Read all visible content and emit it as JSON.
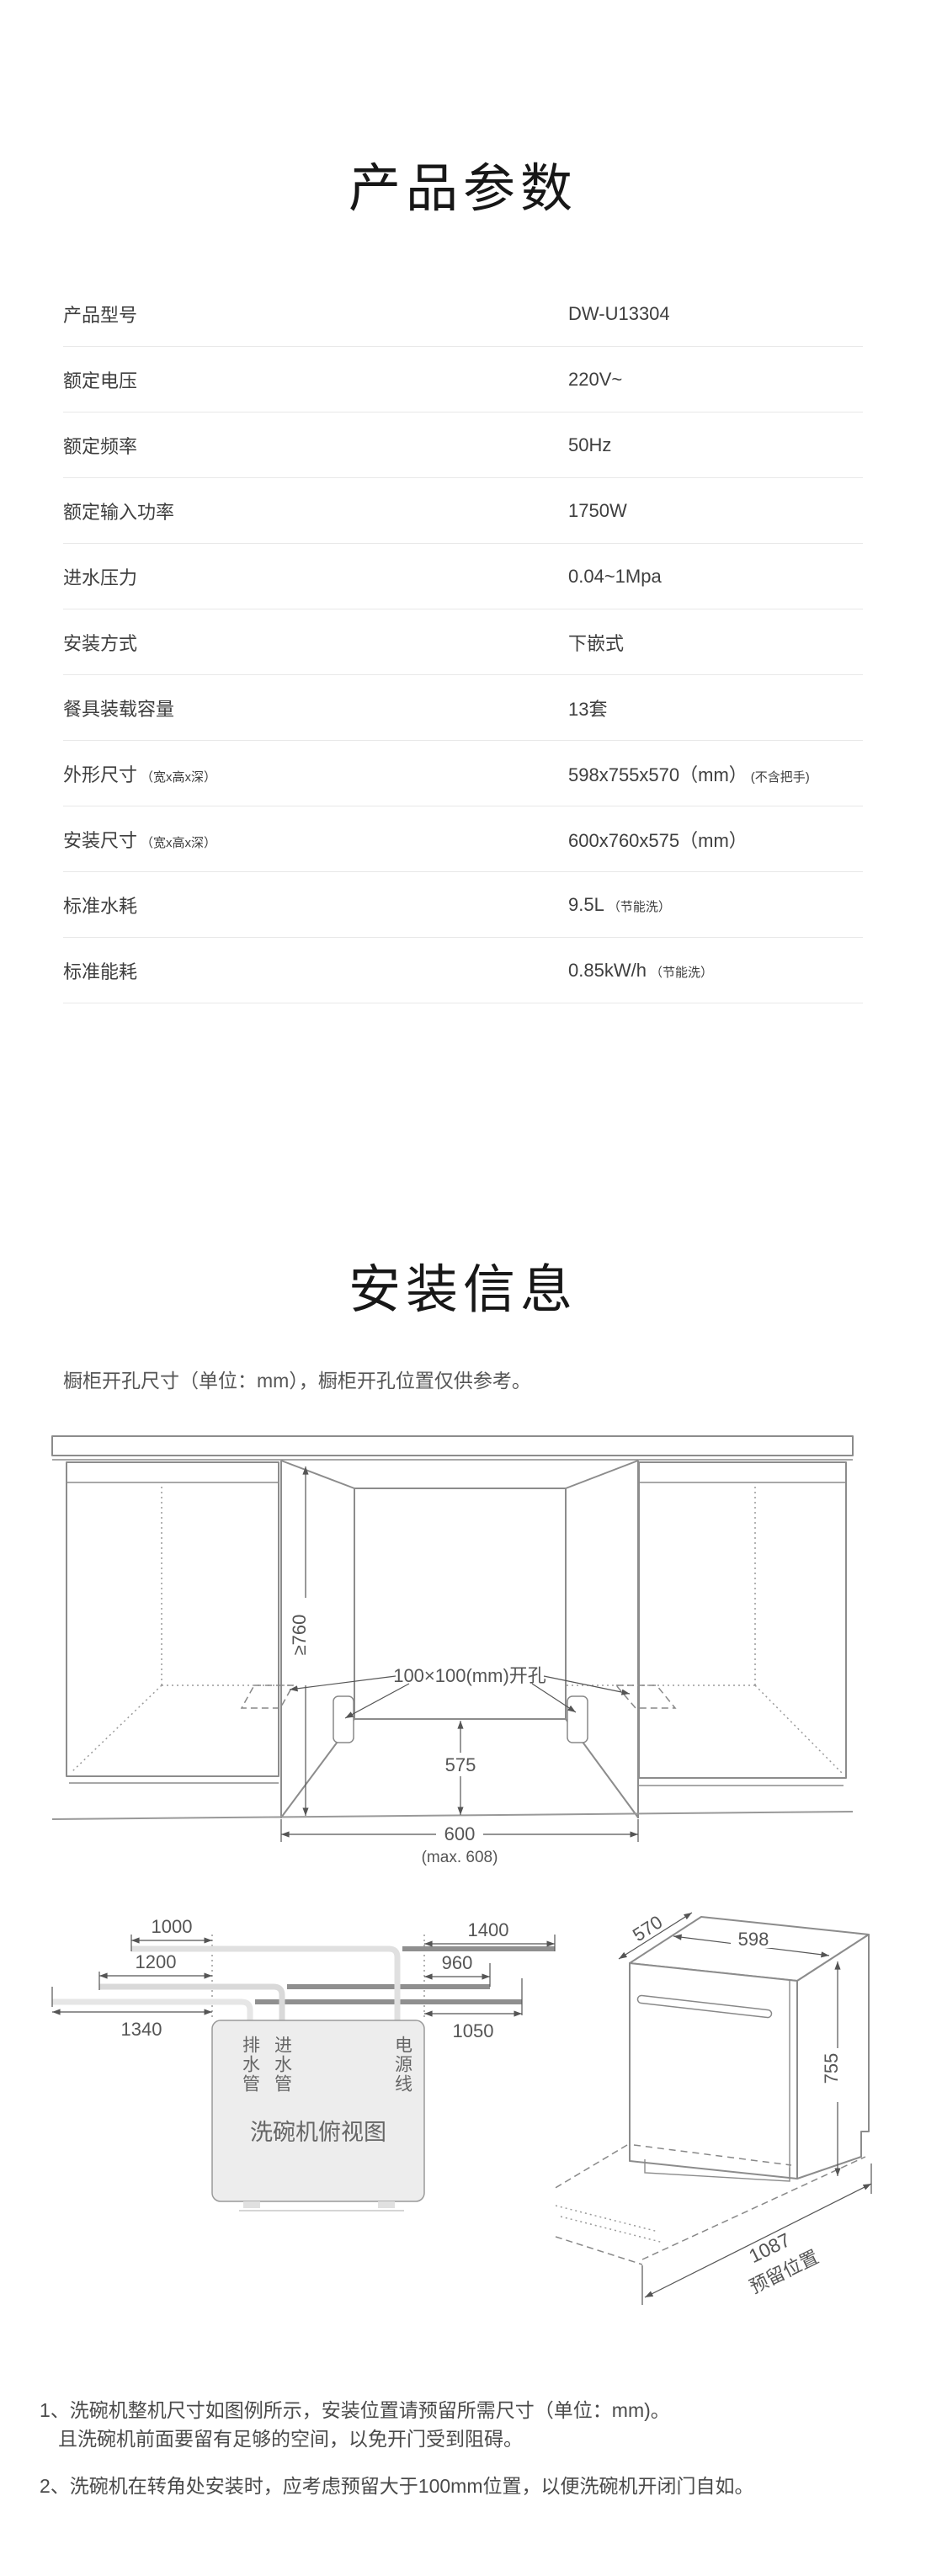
{
  "product_params": {
    "title": "产品参数",
    "rows": [
      {
        "label": "产品型号",
        "label_suffix": "",
        "value": "DW-U13304",
        "value_suffix": ""
      },
      {
        "label": "额定电压",
        "label_suffix": "",
        "value": "220V~",
        "value_suffix": ""
      },
      {
        "label": "额定频率",
        "label_suffix": "",
        "value": "50Hz",
        "value_suffix": ""
      },
      {
        "label": "额定输入功率",
        "label_suffix": "",
        "value": "1750W",
        "value_suffix": ""
      },
      {
        "label": "进水压力",
        "label_suffix": "",
        "value": "0.04~1Mpa",
        "value_suffix": ""
      },
      {
        "label": "安装方式",
        "label_suffix": "",
        "value": "下嵌式",
        "value_suffix": ""
      },
      {
        "label": "餐具装载容量",
        "label_suffix": "",
        "value": "13套",
        "value_suffix": ""
      },
      {
        "label": "外形尺寸",
        "label_suffix": "（宽x高x深）",
        "value": "598x755x570（mm）",
        "value_suffix": "(不含把手)"
      },
      {
        "label": "安装尺寸",
        "label_suffix": "（宽x高x深）",
        "value": "600x760x575（mm）",
        "value_suffix": ""
      },
      {
        "label": "标准水耗",
        "label_suffix": "",
        "value": "9.5L",
        "value_suffix": "（节能洗）"
      },
      {
        "label": "标准能耗",
        "label_suffix": "",
        "value": "0.85kW/h",
        "value_suffix": "（节能洗）"
      }
    ]
  },
  "install_info": {
    "title": "安装信息",
    "caption": "橱柜开孔尺寸（单位：mm），橱柜开孔位置仅供参考。",
    "cutout_diagram": {
      "height_dim": "≥760",
      "opening_label": "100×100(mm)开孔",
      "inner_depth_dim": "575",
      "width_dim": "600",
      "width_max_dim": "(max. 608)"
    },
    "top_view": {
      "left_dims": [
        "1000",
        "1200",
        "1340"
      ],
      "right_dims": [
        "1400",
        "960",
        "1050"
      ],
      "drain_label": "排水管",
      "inlet_label": "进水管",
      "power_label": "电源线",
      "box_label": "洗碗机俯视图"
    },
    "perspective": {
      "depth_dim": "570",
      "width_dim": "598",
      "height_dim": "755",
      "reserve_dim": "1087",
      "reserve_label": "预留位置"
    },
    "notes": [
      "1、洗碗机整机尺寸如图例所示，安装位置请预留所需尺寸（单位：mm)。",
      "且洗碗机前面要留有足够的空间，以免开门受到阻碍。",
      "2、洗碗机在转角处安装时，应考虑预留大于100mm位置，以便洗碗机开闭门自如。"
    ]
  },
  "colors": {
    "background": "#ffffff",
    "text_primary": "#3e3e3e",
    "text_title": "#171717",
    "text_note": "#4a4a4a",
    "divider": "#e8e8e8",
    "diagram_line": "#8c8c8c",
    "dim_line": "#555555",
    "hose_light": "#e0e0e0",
    "hose_dark": "#8f8f8f",
    "box_fill": "#ededed"
  }
}
